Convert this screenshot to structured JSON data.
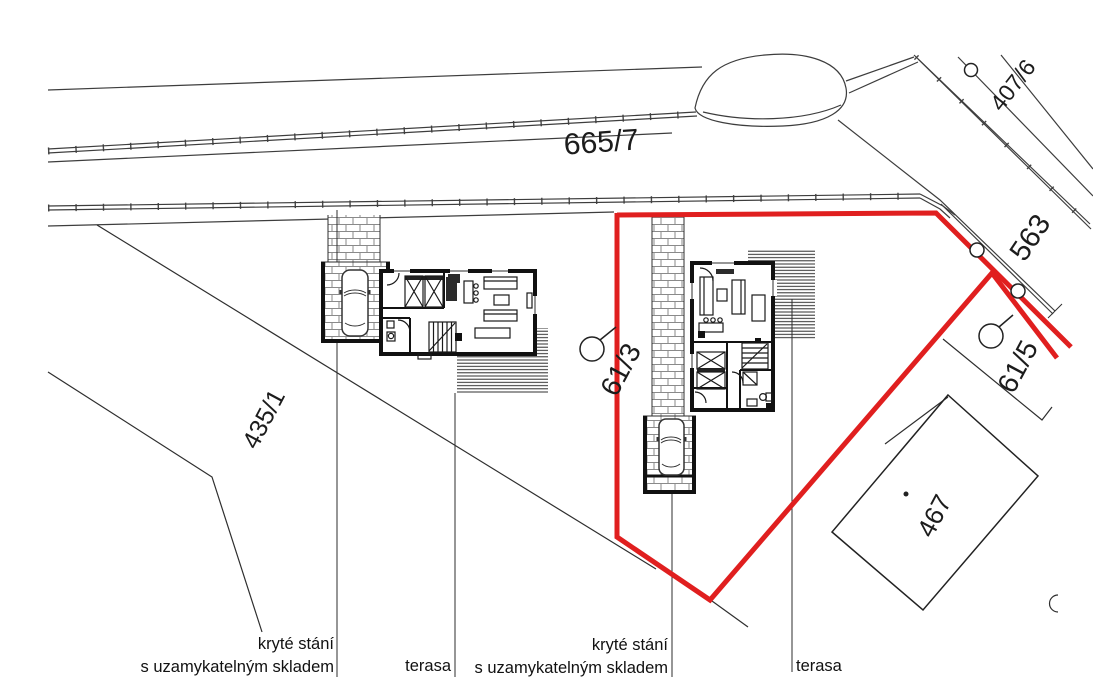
{
  "drawing": {
    "type": "cadastral-site-plan",
    "parcel_labels": {
      "road_top": "665/7",
      "upper_right_road": "407/6",
      "street_right": "563",
      "left_field": "435/1",
      "main_plot": "61/3",
      "right_plot": "61/5",
      "neighbor_building": "467"
    },
    "annotations": {
      "covered_parking_line1": "kryté stání",
      "covered_parking_line2": "s uzamykatelným skladem",
      "terrace": "terasa"
    },
    "colors": {
      "plot_boundary_red": "#e01f1f",
      "drawing_line": "#3d3d3d",
      "wall_black": "#111111"
    }
  }
}
